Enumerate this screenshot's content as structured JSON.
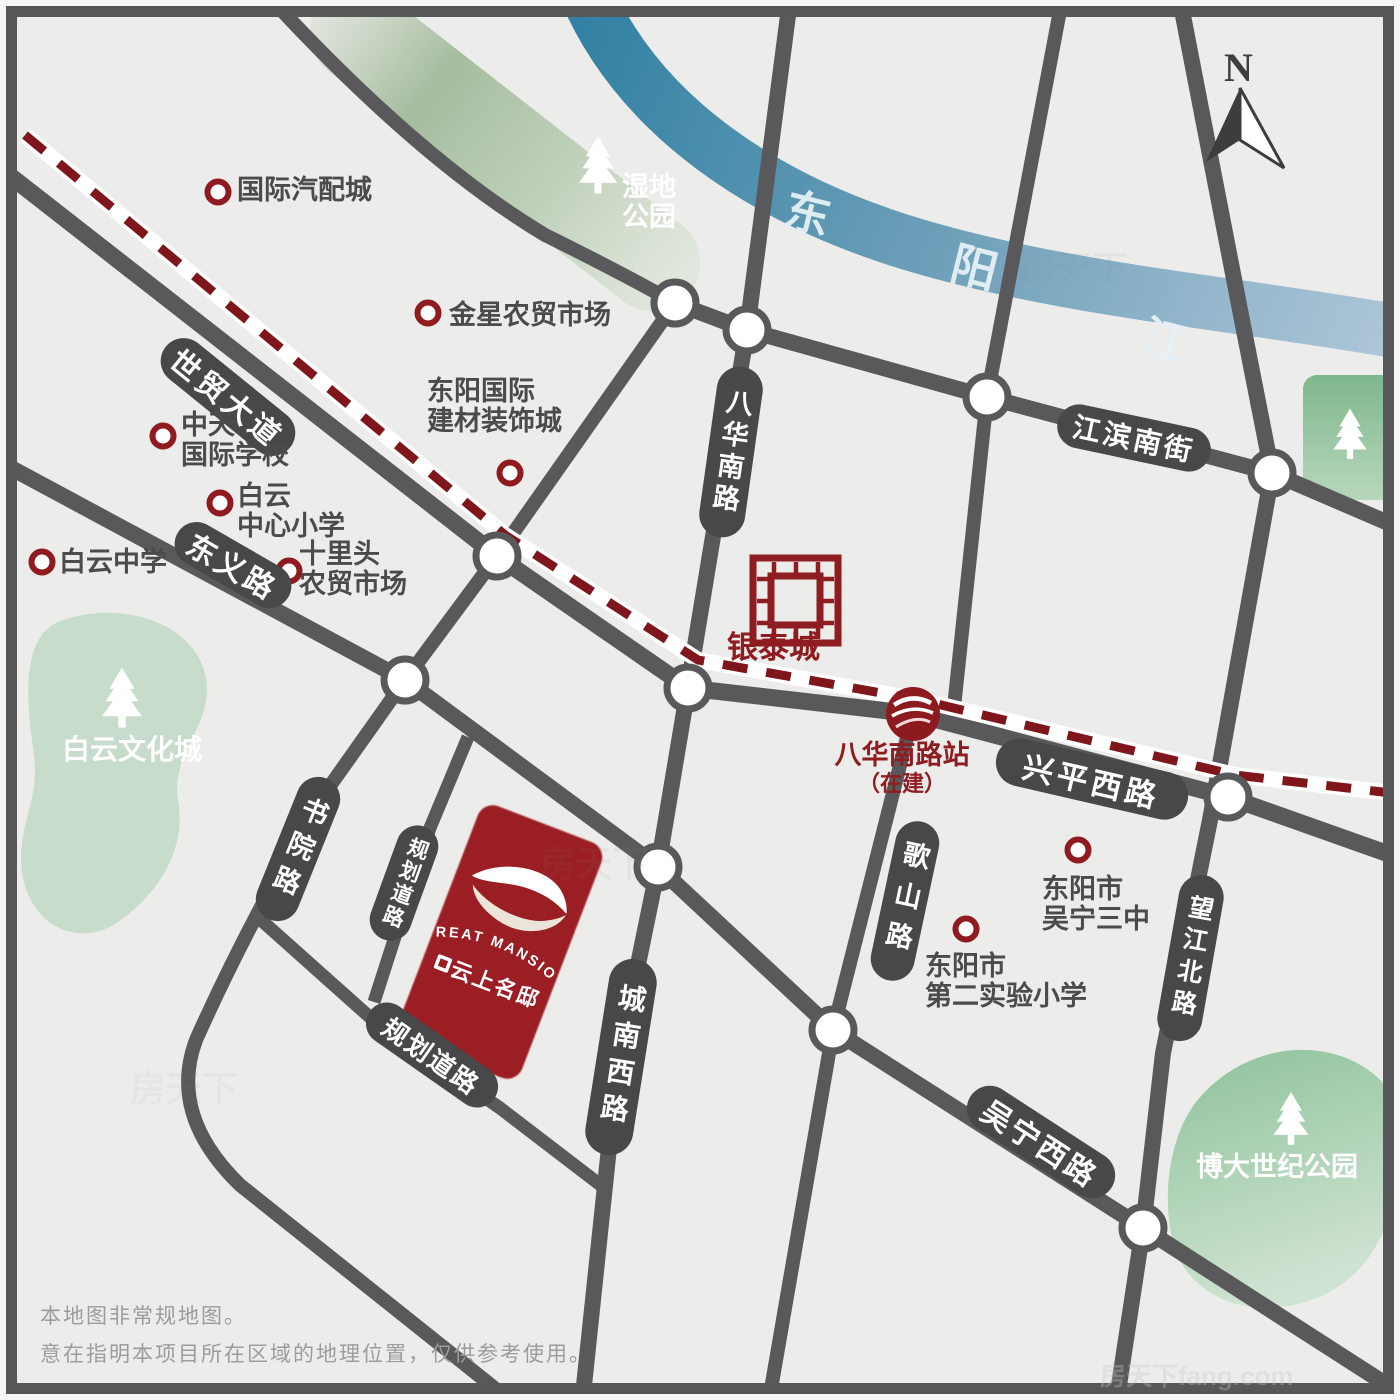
{
  "compass": {
    "n": "N"
  },
  "river": {
    "c1": "东",
    "c2": "阳",
    "c3": "江"
  },
  "roads": {
    "shimao": "世贸大道",
    "dongyi": "东义路",
    "bahua": "八华南路",
    "jiangbin": "江滨南街",
    "xingping": "兴平西路",
    "geshan": "歌山路",
    "chengnan": "城南西路",
    "wangjiang": "望江北路",
    "shuyuan": "书院路",
    "planned1": "规划道路",
    "planned2": "规划道路",
    "wuning": "吴宁西路"
  },
  "pois": {
    "autoparts": {
      "l1": "国际汽配城"
    },
    "jinxing": {
      "l1": "金星农贸市场"
    },
    "dyintl": {
      "l1": "东阳国际",
      "l2": "建材装饰城"
    },
    "zhongtian": {
      "l1": "中天",
      "l2": "国际学校"
    },
    "byprimary": {
      "l1": "白云",
      "l2": "中心小学"
    },
    "shilitou": {
      "l1": "十里头",
      "l2": "农贸市场"
    },
    "bymiddle": {
      "l1": "白云中学"
    },
    "wuning3": {
      "l1": "东阳市",
      "l2": "吴宁三中"
    },
    "exp2": {
      "l1": "东阳市",
      "l2": "第二实验小学"
    }
  },
  "parks": {
    "shidi": {
      "l1": "湿地",
      "l2": "公园"
    },
    "baiyun": "白云文化城",
    "boda": "博大世纪公园"
  },
  "landmarks": {
    "yintai": "银泰城",
    "station": {
      "name": "八华南路站",
      "status": "（在建）"
    }
  },
  "property": {
    "brand_en": "GREAT MANSION",
    "brand_cn": "云上名邸"
  },
  "disclaimer": {
    "l1": "本地图非常规地图。",
    "l2": "意在指明本项目所在区域的地理位置，仅供参考使用。"
  },
  "watermark": {
    "short": "房天下",
    "full": "房天下fang.com"
  },
  "colors": {
    "road": "#59595B",
    "pill": "#48484A",
    "accent_red": "#9A1E23",
    "rail_red": "#7E161B",
    "river_start": "#2E7FA2",
    "river_end": "#AEC6D8",
    "park_green": "#8CBE96",
    "bg": "#ECECEA"
  }
}
